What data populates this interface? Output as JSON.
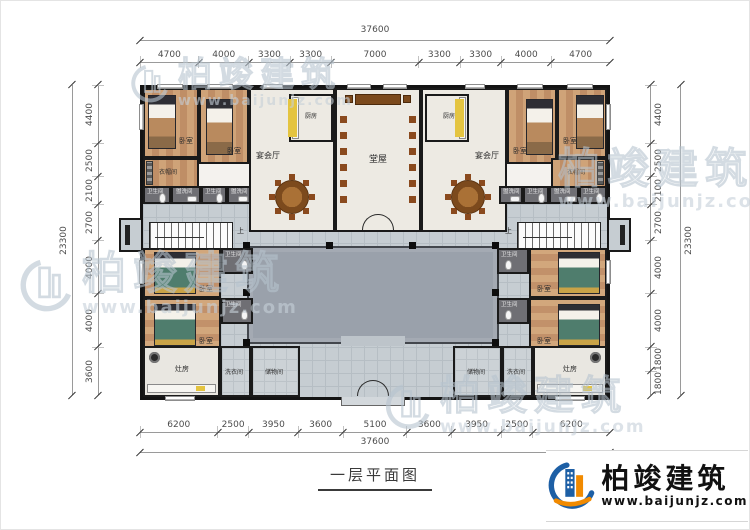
{
  "page": {
    "title_label": "一层平面图"
  },
  "logo": {
    "name": "柏竣建筑",
    "url": "www.baijunjz.com"
  },
  "watermark": {
    "name": "柏竣建筑",
    "url": "www.baijunjz.com"
  },
  "dimensions": {
    "top": {
      "total": "37600",
      "segments": [
        4700,
        4000,
        3300,
        3300,
        7000,
        3300,
        3300,
        4000,
        4700
      ]
    },
    "bottom": {
      "total": "37600",
      "segments": [
        6200,
        2500,
        3950,
        3600,
        5100,
        3600,
        3950,
        2500,
        6200
      ]
    },
    "left": {
      "total": "23300",
      "segments": [
        4400,
        2500,
        2100,
        2700,
        4000,
        4000,
        3600
      ]
    },
    "right": {
      "total": "23300",
      "segments": [
        4400,
        2500,
        2100,
        2700,
        4000,
        4000,
        1800,
        1800
      ]
    }
  },
  "rooms": {
    "bedroom": "卧室",
    "banquet_hall": "宴会厅",
    "kitchen": "厨房",
    "main_hall": "堂屋",
    "cloakroom": "衣帽间",
    "bathroom": "卫生间",
    "washroom": "盥洗间",
    "stove_room": "灶房",
    "laundry": "洗衣间",
    "storage": "储物间",
    "stairs_up": "上"
  }
}
